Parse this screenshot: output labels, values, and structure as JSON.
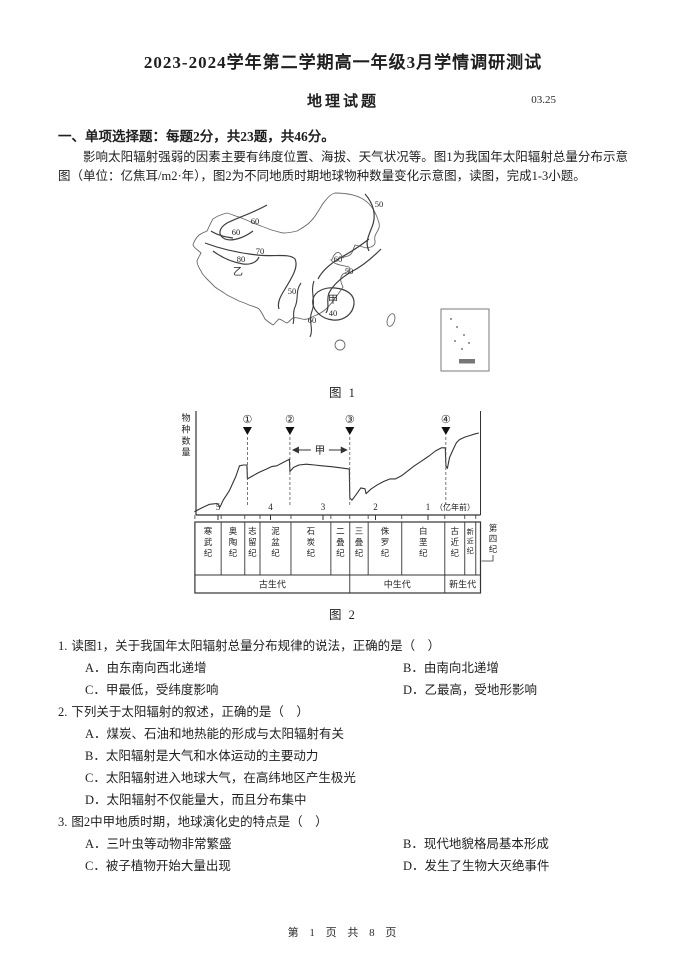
{
  "page": {
    "title": "2023-2024学年第二学期高一年级3月学情调研测试",
    "subject": "地理试题",
    "date_code": "03.25",
    "section_heading": "一、单项选择题：每题2分，共23题，共46分。",
    "intro": "影响太阳辐射强弱的因素主要有纬度位置、海拔、天气状况等。图1为我国年太阳辐射总量分布示意图（单位：亿焦耳/m2·年），图2为不同地质时期地球物种数量变化示意图，读图，完成1-3小题。",
    "footer": "第 1 页 共 8 页"
  },
  "figure1": {
    "caption": "图 1",
    "description": "我国年太阳辐射总量分布示意图",
    "contour_labels": [
      {
        "text": "50",
        "x": 196,
        "y": 16
      },
      {
        "text": "60",
        "x": 72,
        "y": 33
      },
      {
        "text": "60",
        "x": 53,
        "y": 44
      },
      {
        "text": "70",
        "x": 77,
        "y": 63
      },
      {
        "text": "80",
        "x": 58,
        "y": 71
      },
      {
        "text": "乙",
        "x": 55,
        "y": 84
      },
      {
        "text": "60",
        "x": 155,
        "y": 71
      },
      {
        "text": "50",
        "x": 166,
        "y": 83
      },
      {
        "text": "50",
        "x": 109,
        "y": 103
      },
      {
        "text": "甲",
        "x": 150,
        "y": 112
      },
      {
        "text": "40",
        "x": 150,
        "y": 125
      },
      {
        "text": "60",
        "x": 129,
        "y": 132
      }
    ]
  },
  "chart_data": {
    "type": "line",
    "caption": "图 2",
    "title": "不同地质时期地球物种数量变化示意图",
    "ylabel": "物种数量",
    "x_unit_label": "（亿年前）",
    "x_ticks": [
      5,
      4,
      3,
      2,
      1
    ],
    "x_range": [
      5.44,
      0
    ],
    "x_axis_note": "time before present, decreasing to the right",
    "extinction_markers": [
      {
        "label": "①",
        "x": 4.44
      },
      {
        "label": "②",
        "x": 3.63
      },
      {
        "label": "③",
        "x": 2.49
      },
      {
        "label": "④",
        "x": 0.66
      }
    ],
    "annotation": {
      "label": "甲",
      "from_x": 3.63,
      "to_x": 2.49
    },
    "series": [
      {
        "name": "物种数量",
        "points": [
          [
            5.45,
            4
          ],
          [
            5.3,
            9
          ],
          [
            5.16,
            13
          ],
          [
            5.02,
            14
          ],
          [
            4.96,
            10
          ],
          [
            4.9,
            18
          ],
          [
            4.78,
            30
          ],
          [
            4.66,
            47
          ],
          [
            4.59,
            60
          ],
          [
            4.52,
            61
          ],
          [
            4.45,
            61
          ],
          [
            4.44,
            44
          ],
          [
            4.36,
            47
          ],
          [
            4.22,
            52
          ],
          [
            4.08,
            56
          ],
          [
            3.98,
            59
          ],
          [
            3.88,
            60
          ],
          [
            3.76,
            64
          ],
          [
            3.64,
            68
          ],
          [
            3.63,
            53
          ],
          [
            3.56,
            58
          ],
          [
            3.46,
            61
          ],
          [
            3.32,
            62
          ],
          [
            3.16,
            61
          ],
          [
            3.02,
            60
          ],
          [
            2.86,
            59
          ],
          [
            2.72,
            58
          ],
          [
            2.6,
            57
          ],
          [
            2.5,
            56
          ],
          [
            2.49,
            21
          ],
          [
            2.45,
            18
          ],
          [
            2.38,
            24
          ],
          [
            2.28,
            33
          ],
          [
            2.2,
            32
          ],
          [
            2.18,
            26
          ],
          [
            2.08,
            32
          ],
          [
            1.96,
            37
          ],
          [
            1.84,
            41
          ],
          [
            1.72,
            44
          ],
          [
            1.62,
            44
          ],
          [
            1.5,
            48
          ],
          [
            1.38,
            54
          ],
          [
            1.26,
            60
          ],
          [
            1.12,
            66
          ],
          [
            0.98,
            72
          ],
          [
            0.86,
            78
          ],
          [
            0.74,
            82
          ],
          [
            0.67,
            82
          ],
          [
            0.66,
            60
          ],
          [
            0.63,
            57
          ],
          [
            0.59,
            70
          ],
          [
            0.52,
            80
          ],
          [
            0.46,
            88
          ],
          [
            0.4,
            92
          ],
          [
            0.3,
            95
          ],
          [
            0.2,
            97
          ],
          [
            0.1,
            99
          ],
          [
            0.03,
            100
          ]
        ]
      }
    ],
    "geologic_periods": [
      {
        "name": "寒武纪",
        "start": 5.44,
        "end": 4.94,
        "era": "古生代"
      },
      {
        "name": "奥陶纪",
        "start": 4.94,
        "end": 4.49,
        "era": "古生代"
      },
      {
        "name": "志留纪",
        "start": 4.49,
        "end": 4.2,
        "era": "古生代"
      },
      {
        "name": "泥盆纪",
        "start": 4.2,
        "end": 3.61,
        "era": "古生代"
      },
      {
        "name": "石炭纪",
        "start": 3.61,
        "end": 2.85,
        "era": "古生代"
      },
      {
        "name": "二叠纪",
        "start": 2.85,
        "end": 2.49,
        "era": "古生代"
      },
      {
        "name": "三叠纪",
        "start": 2.49,
        "end": 2.14,
        "era": "中生代"
      },
      {
        "name": "侏罗纪",
        "start": 2.14,
        "end": 1.5,
        "era": "中生代"
      },
      {
        "name": "白垩纪",
        "start": 1.5,
        "end": 0.68,
        "era": "中生代"
      },
      {
        "name": "古近纪",
        "start": 0.68,
        "end": 0.3,
        "era": "新生代"
      },
      {
        "name": "新近纪",
        "start": 0.3,
        "end": 0.09,
        "era": "新生代"
      },
      {
        "name": "第四纪",
        "start": 0.09,
        "end": 0.0,
        "era": "新生代"
      }
    ],
    "eras": [
      {
        "name": "古生代",
        "start": 5.44,
        "end": 2.49
      },
      {
        "name": "中生代",
        "start": 2.49,
        "end": 0.68
      },
      {
        "name": "新生代",
        "start": 0.68,
        "end": 0.0
      }
    ]
  },
  "questions": [
    {
      "number": "1.",
      "stem": "读图1，关于我国年太阳辐射总量分布规律的说法，正确的是（　）",
      "options": [
        "A．由东南向西北递增",
        "B．由南向北递增",
        "C．甲最低，受纬度影响",
        "D．乙最高，受地形影响"
      ]
    },
    {
      "number": "2.",
      "stem": "下列关于太阳辐射的叙述，正确的是（　）",
      "options": [
        "A．煤炭、石油和地热能的形成与太阳辐射有关",
        "B．太阳辐射是大气和水体运动的主要动力",
        "C．太阳辐射进入地球大气，在高纬地区产生极光",
        "D．太阳辐射不仅能量大，而且分布集中"
      ]
    },
    {
      "number": "3.",
      "stem": "图2中甲地质时期，地球演化史的特点是（　）",
      "options": [
        "A．三叶虫等动物非常繁盛",
        "B．现代地貌格局基本形成",
        "C．被子植物开始大量出现",
        "D．发生了生物大灭绝事件"
      ]
    }
  ]
}
